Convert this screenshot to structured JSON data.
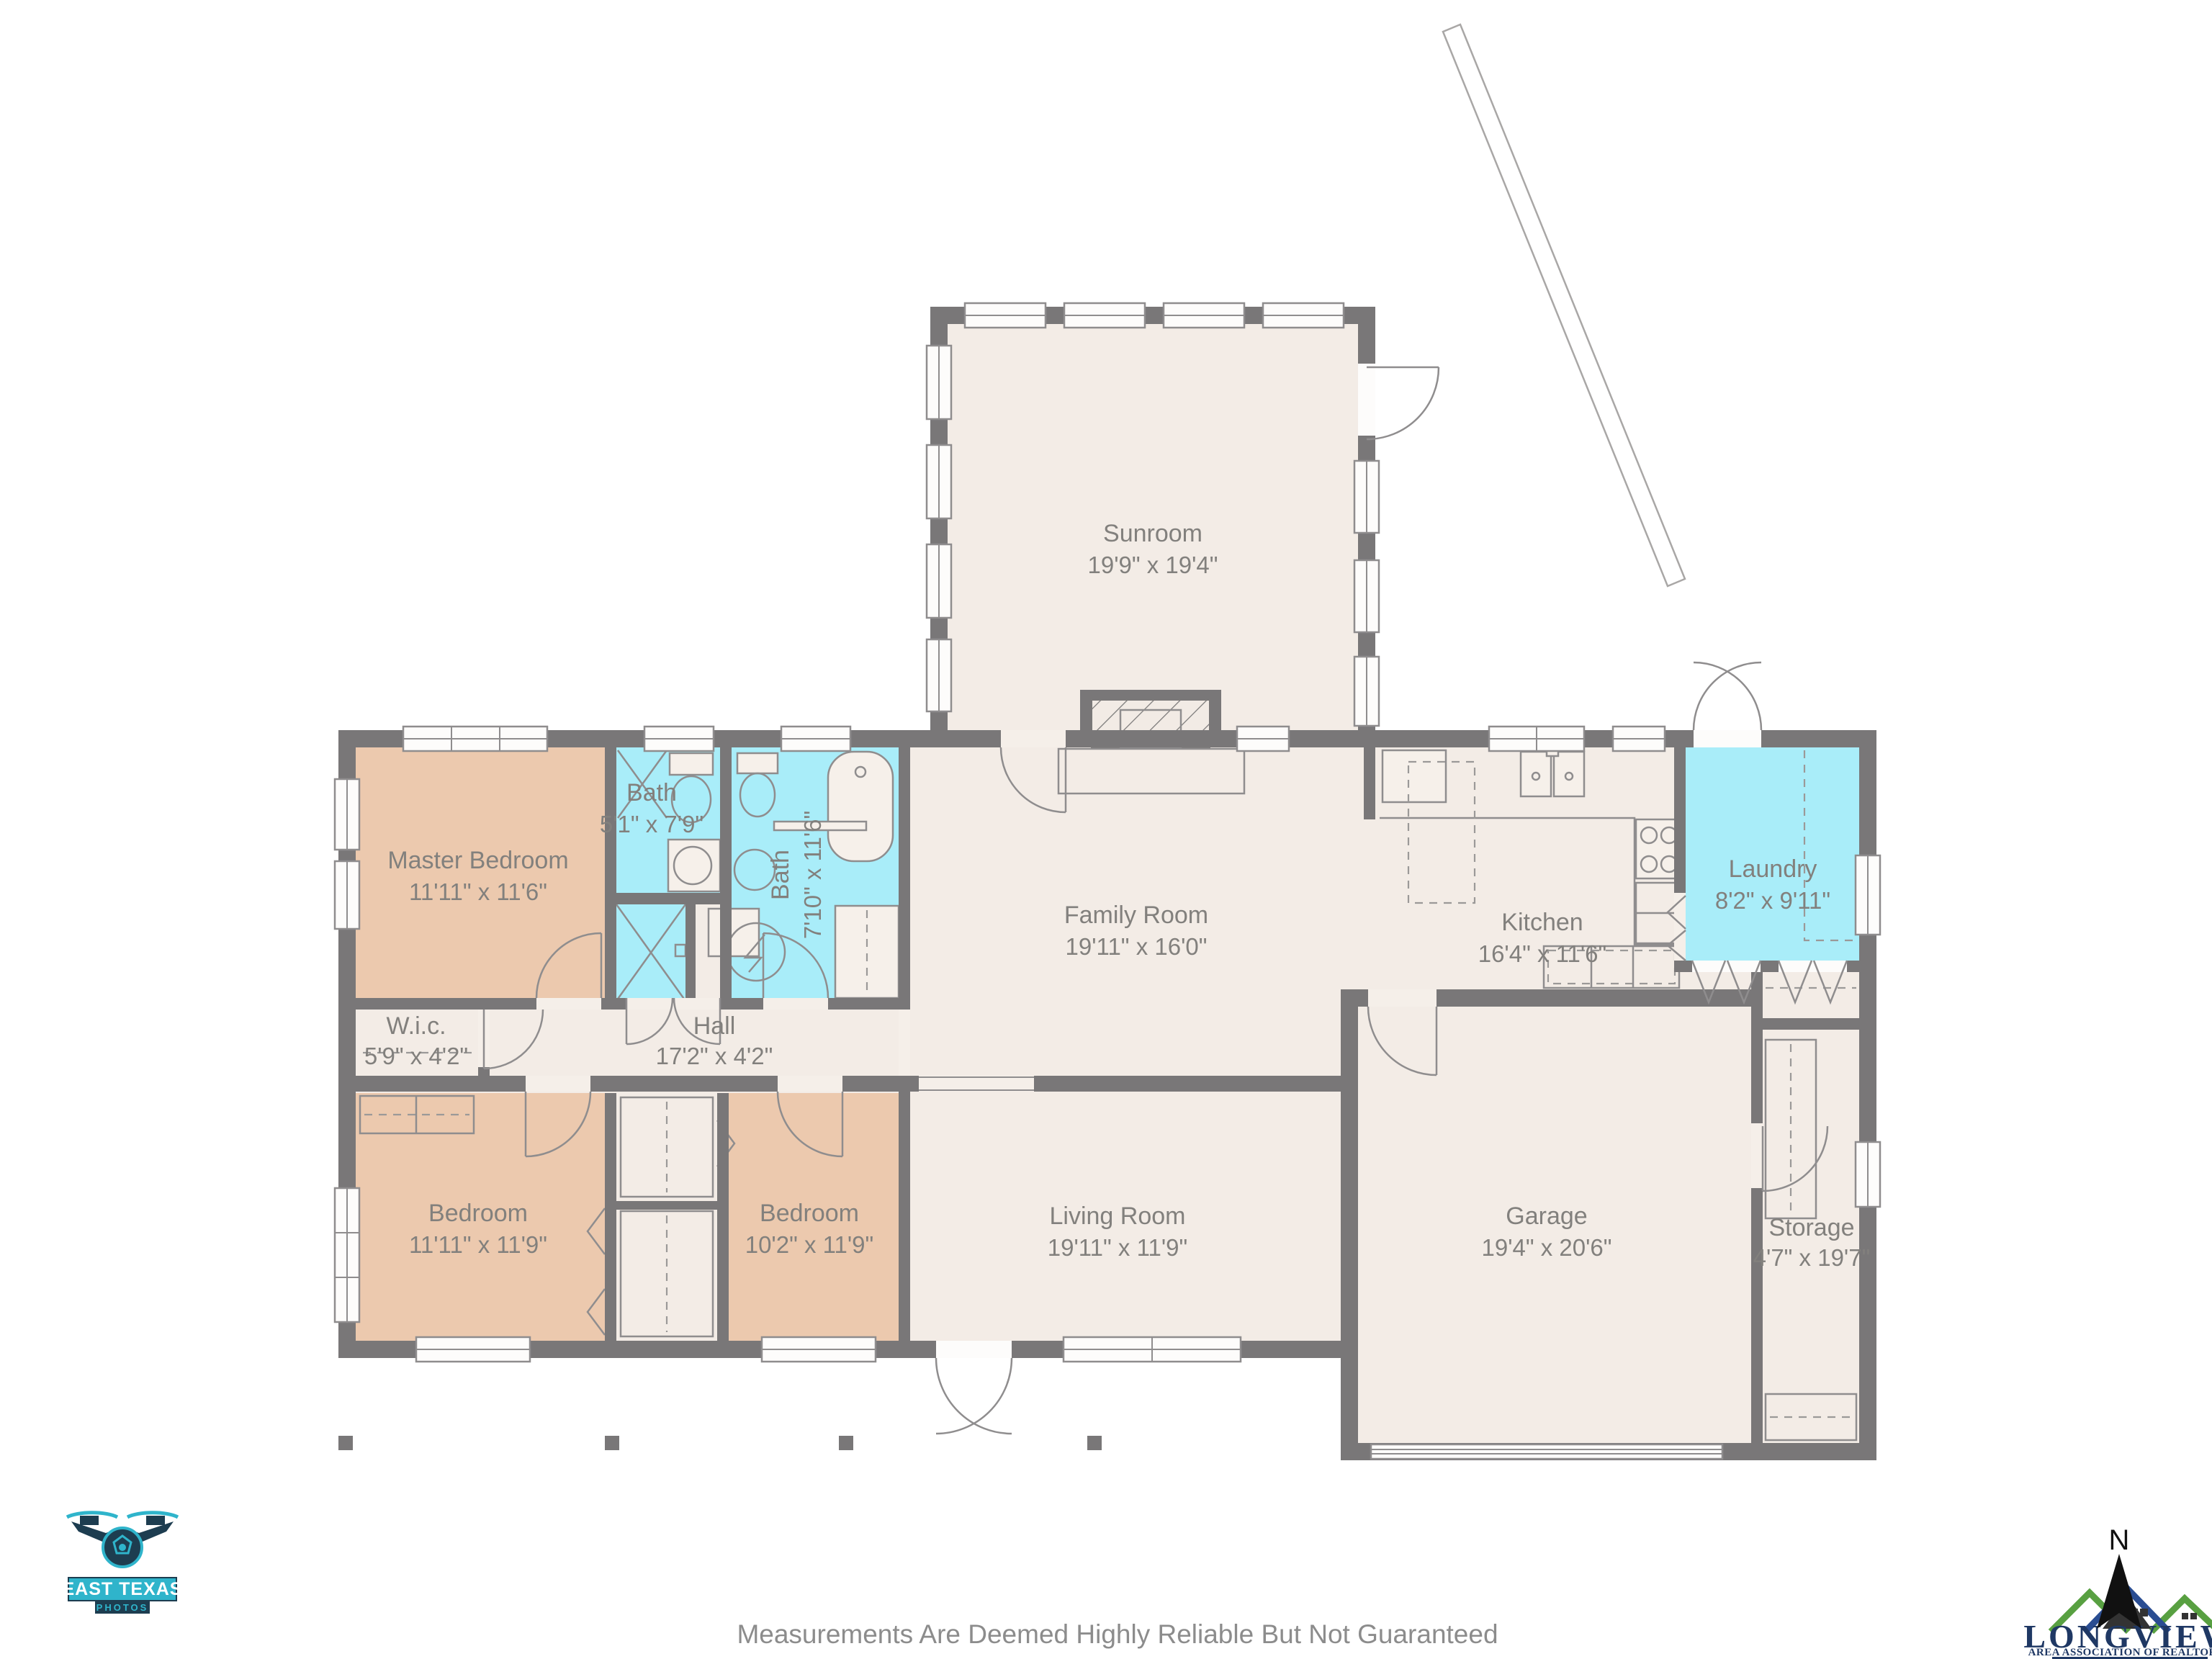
{
  "page": {
    "disclaimer": "Measurements Are Deemed Highly Reliable But Not Guaranteed"
  },
  "colors": {
    "wall": "#797778",
    "floor_beige": "#f3ece6",
    "bedroom_tan": "#ecc9ae",
    "wet_room_cyan": "#a9edf9",
    "label_gray": "#82807d",
    "photographer_teal": "#2fb4cb",
    "photographer_navy": "#1d3d50",
    "association_navy": "#1f3864",
    "association_green": "#58a041",
    "association_blue": "#2a4d92"
  },
  "rooms": [
    {
      "id": "sunroom",
      "name": "Sunroom",
      "dims": "19'9\" x 19'4\""
    },
    {
      "id": "master-bedroom",
      "name": "Master Bedroom",
      "dims": "11'11\" x 11'6\""
    },
    {
      "id": "bath-small",
      "name": "Bath",
      "dims": "5'1\" x 7'9\""
    },
    {
      "id": "bath-large",
      "name": "Bath",
      "dims": "7'10\" x 11'6\""
    },
    {
      "id": "family-room",
      "name": "Family Room",
      "dims": "19'11\" x 16'0\""
    },
    {
      "id": "kitchen",
      "name": "Kitchen",
      "dims": "16'4\" x 11'6\""
    },
    {
      "id": "laundry",
      "name": "Laundry",
      "dims": "8'2\" x 9'11\""
    },
    {
      "id": "wic",
      "name": "W.i.c.",
      "dims": "5'9\" x 4'2\""
    },
    {
      "id": "hall",
      "name": "Hall",
      "dims": "17'2\" x 4'2\""
    },
    {
      "id": "bedroom-left",
      "name": "Bedroom",
      "dims": "11'11\" x 11'9\""
    },
    {
      "id": "bedroom-middle",
      "name": "Bedroom",
      "dims": "10'2\" x 11'9\""
    },
    {
      "id": "living-room",
      "name": "Living Room",
      "dims": "19'11\" x 11'9\""
    },
    {
      "id": "garage",
      "name": "Garage",
      "dims": "19'4\" x 20'6\""
    },
    {
      "id": "storage",
      "name": "Storage",
      "dims": "4'7\" x 19'7\""
    }
  ],
  "compass": {
    "label": "N"
  },
  "branding": {
    "photographer": {
      "line1": "EAST TEXAS",
      "line2": "PHOTOS"
    },
    "association": {
      "name": "LONGVIEW",
      "tagline": "AREA ASSOCIATION OF REALTORS®"
    }
  }
}
